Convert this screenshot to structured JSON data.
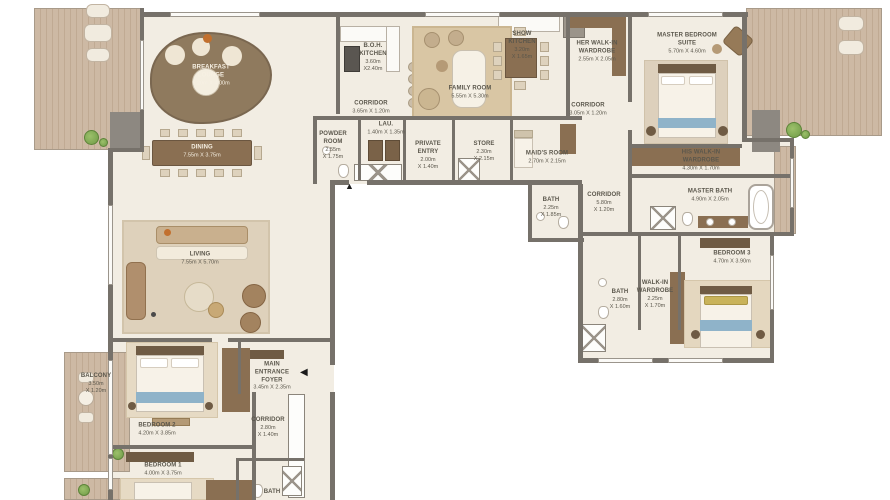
{
  "colors": {
    "floor": "#f2ede3",
    "wall": "#76716a",
    "deck_wood": "#c9b39e",
    "furniture_wood": "#8a6f52",
    "bed_runner_blue": "#8fb3c9",
    "pillow_yellow": "#c9b35a",
    "accent_orange": "#c2702e",
    "plant_green": "#7da257"
  },
  "icons": {
    "main_entrance_arrow": "◀",
    "private_entry_arrow": "▲"
  },
  "rooms": {
    "breakfast_lounge": {
      "name": "BREAKFAST\nLOUNGE",
      "dims": "5.20m X 4.00m"
    },
    "dining": {
      "name": "DINING",
      "dims": "7.55m X 3.75m"
    },
    "show_kitchen": {
      "name": "SHOW\nKITCHEN",
      "dims": "3.20m\nX 1.65m"
    },
    "boh_kitchen": {
      "name": "B.O.H.\nKITCHEN",
      "dims": "3.60m\nX2.40m"
    },
    "corridor_top_left": {
      "name": "CORRIDOR",
      "dims": "3.65m X 1.20m"
    },
    "family_room": {
      "name": "FAMILY ROOM",
      "dims": "5.55m X 5.30m"
    },
    "her_wardrobe": {
      "name": "HER WALK-IN\nWARDROBE",
      "dims": "2.55m X 2.05m"
    },
    "corridor_top_right": {
      "name": "CORRIDOR",
      "dims": "3.05m X 1.20m"
    },
    "master_suite": {
      "name": "MASTER BEDROOM\nSUITE",
      "dims": "5.70m X 4.60m"
    },
    "his_wardrobe": {
      "name": "HIS WALK-IN\nWARDROBE",
      "dims": "4.30m X 1.70m"
    },
    "master_bath": {
      "name": "MASTER BATH",
      "dims": "4.90m X 2.05m"
    },
    "powder_room": {
      "name": "POWDER\nROOM",
      "dims": "2.55m\nX 1.75m"
    },
    "laundry": {
      "name": "LAU.",
      "dims": "1.40m X 1.35m"
    },
    "private_entry": {
      "name": "PRIVATE\nENTRY",
      "dims": "2.00m\nX 1.40m"
    },
    "store": {
      "name": "STORE",
      "dims": "2.30m\nX 2.15m"
    },
    "maids_room": {
      "name": "MAID'S ROOM",
      "dims": "2.70m X 2.15m"
    },
    "maids_bath": {
      "name": "BATH",
      "dims": "2.25m\nX 1.85m"
    },
    "corridor_right": {
      "name": "CORRIDOR",
      "dims": "5.80m\nX 1.20m"
    },
    "bedroom_3": {
      "name": "BEDROOM 3",
      "dims": "4.70m X 3.90m"
    },
    "walkin_wardrobe": {
      "name": "WALK-IN\nWARDROBE",
      "dims": "2.25m\nX 1.70m"
    },
    "bath_3": {
      "name": "BATH",
      "dims": "2.80m\nX 1.60m"
    },
    "living": {
      "name": "LIVING",
      "dims": "7.55m X 5.70m"
    },
    "main_foyer": {
      "name": "MAIN\nENTRANCE\nFOYER",
      "dims": "3.45m X 2.35m"
    },
    "bedroom_2": {
      "name": "BEDROOM 2",
      "dims": "4.20m X 3.85m"
    },
    "corridor_bottom": {
      "name": "CORRIDOR",
      "dims": "2.80m\nX 1.40m"
    },
    "bedroom_1": {
      "name": "BEDROOM 1",
      "dims": "4.00m X 3.75m"
    },
    "bath_bottom": {
      "name": "BATH",
      "dims": ""
    },
    "balcony": {
      "name": "BALCONY",
      "dims": "3.50m\nX 1.20m"
    }
  }
}
